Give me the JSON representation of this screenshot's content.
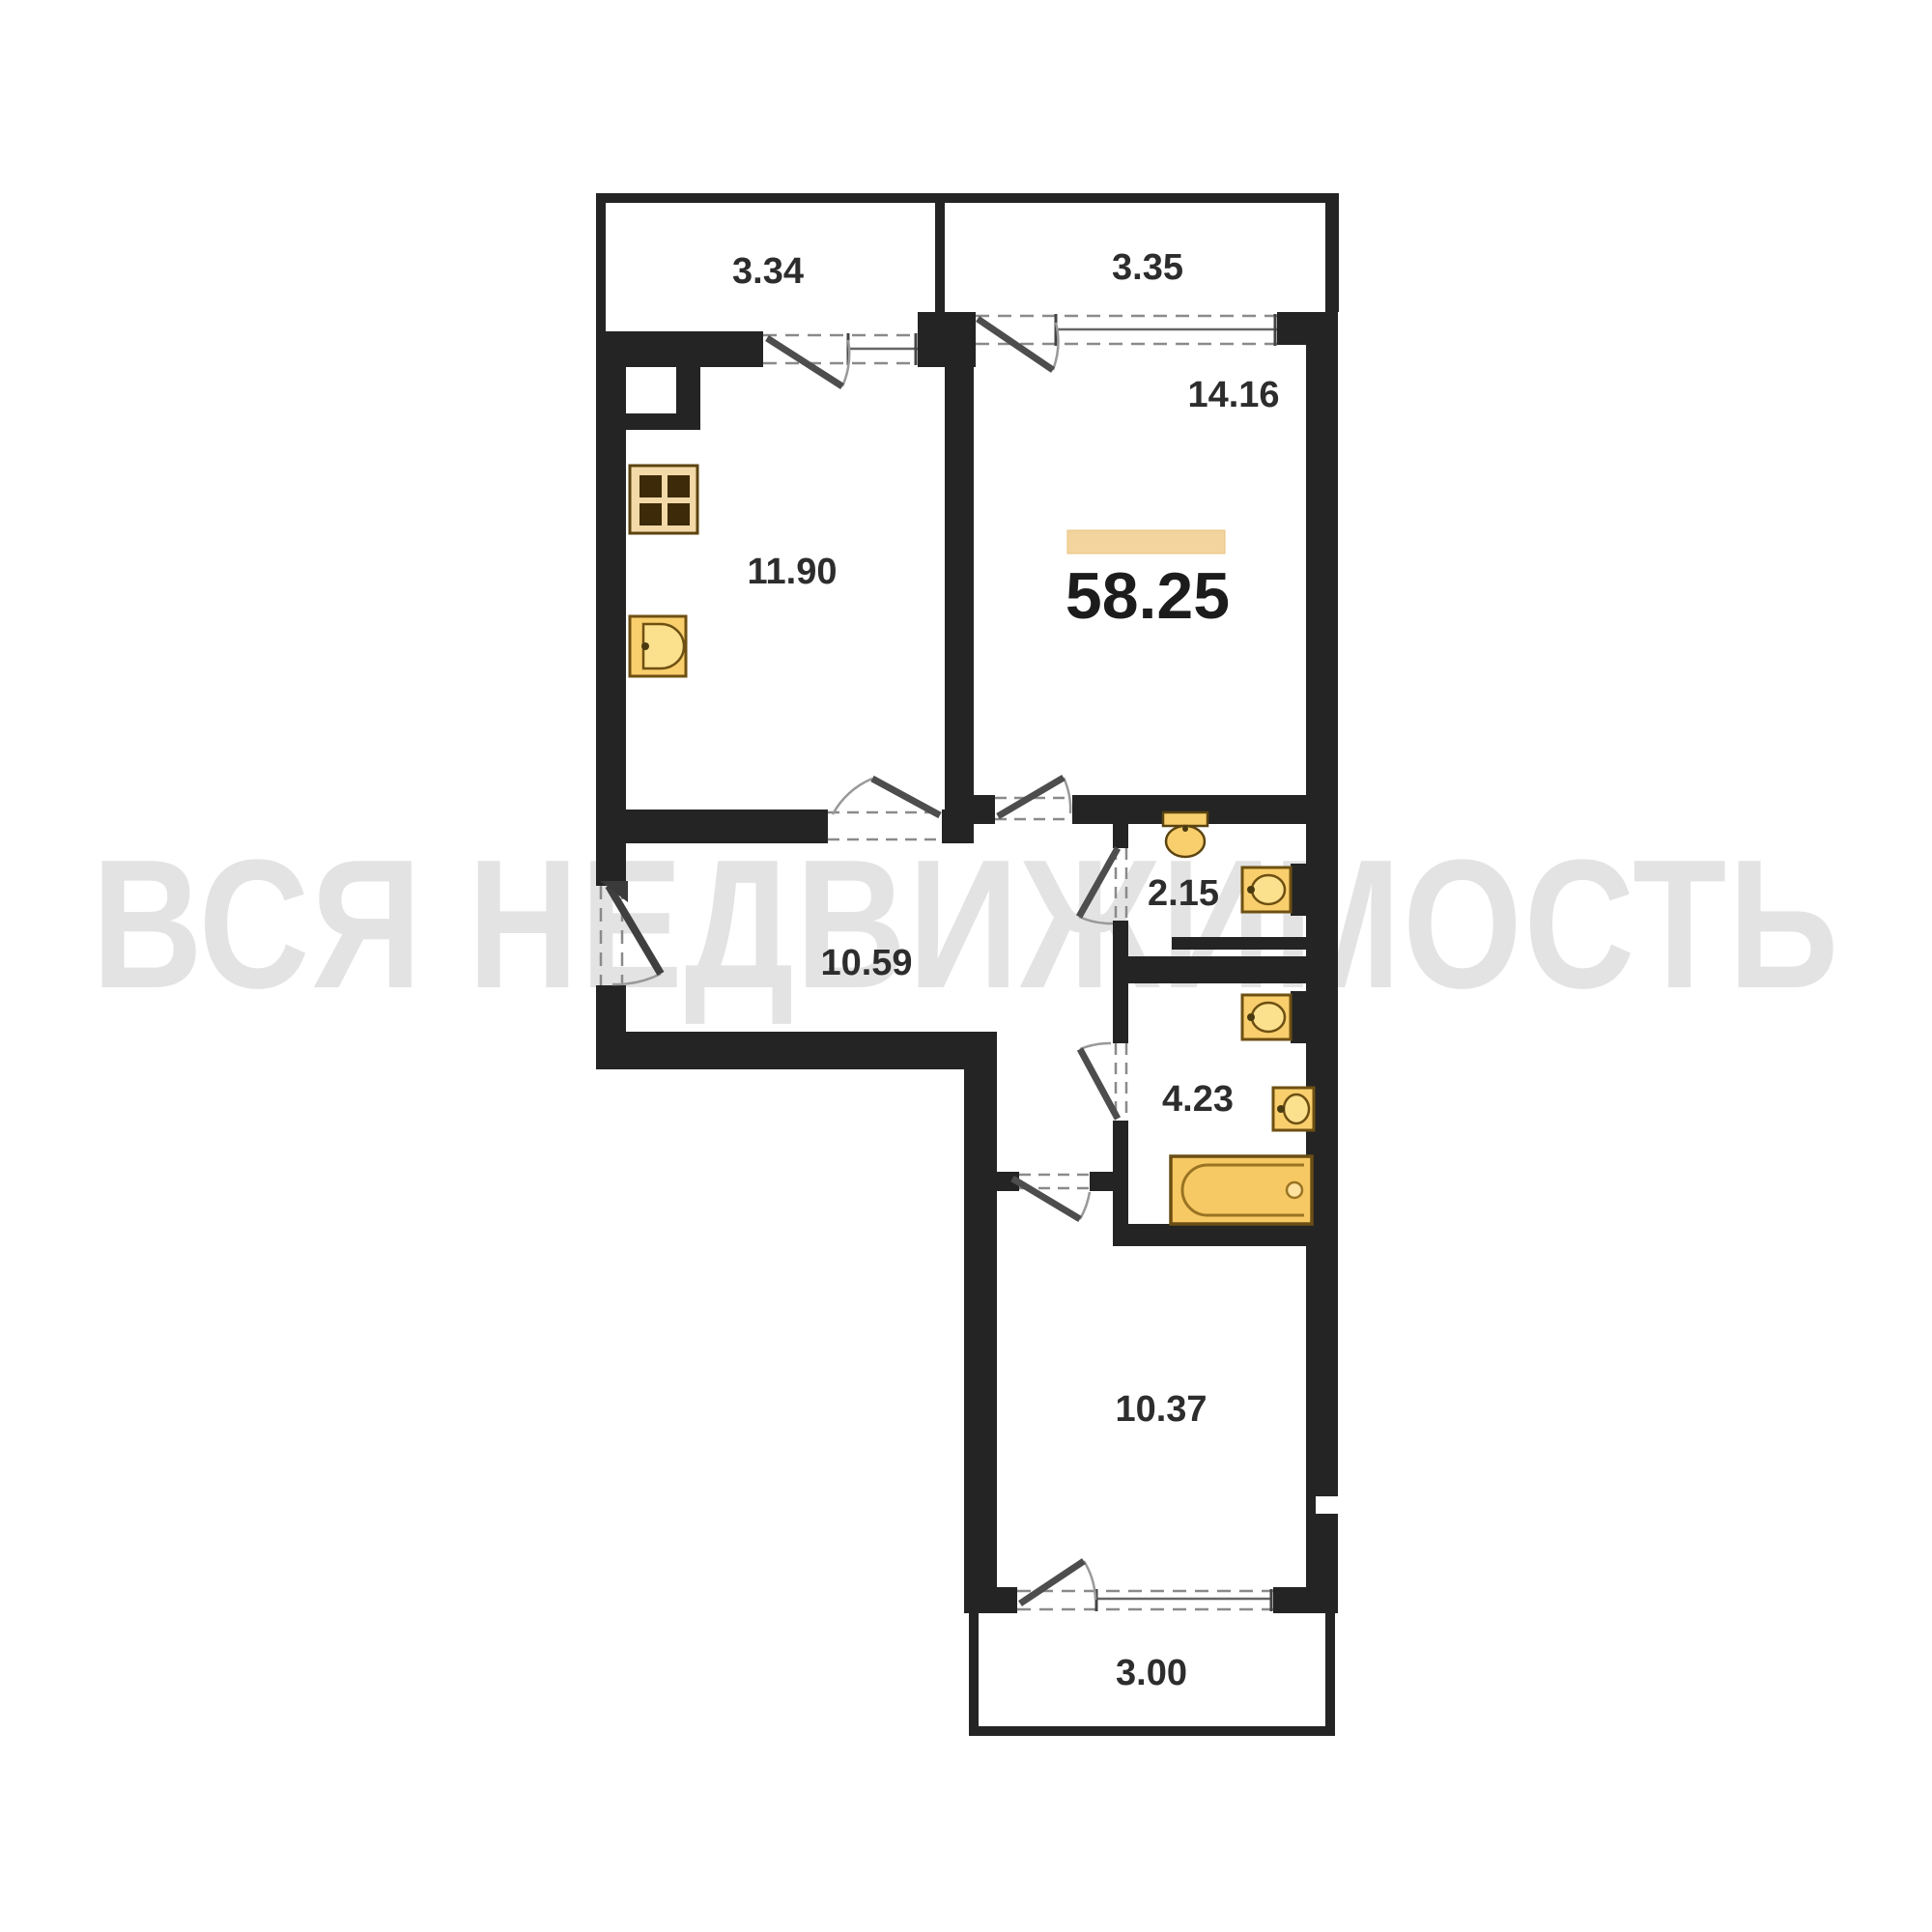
{
  "watermark_text": "ВСЯ НЕДВИЖИМОСТЬ",
  "total_area_label": "58.25",
  "rooms": [
    {
      "name": "balcony-top-left",
      "area": "3.34"
    },
    {
      "name": "balcony-top-right",
      "area": "3.35"
    },
    {
      "name": "living-room",
      "area": "14.16"
    },
    {
      "name": "kitchen",
      "area": "11.90"
    },
    {
      "name": "hallway",
      "area": "10.59"
    },
    {
      "name": "wc",
      "area": "2.15"
    },
    {
      "name": "bathroom",
      "area": "4.23"
    },
    {
      "name": "bedroom",
      "area": "10.37"
    },
    {
      "name": "balcony-bottom",
      "area": "3.00"
    }
  ],
  "colors": {
    "wall": "#242424",
    "fixture_fill": "#f8cf6d",
    "fixture_border": "#6e5012",
    "accent_bar": "#f3d49e",
    "watermark": "#e3e3e3",
    "label_text": "#2d2d2d"
  }
}
